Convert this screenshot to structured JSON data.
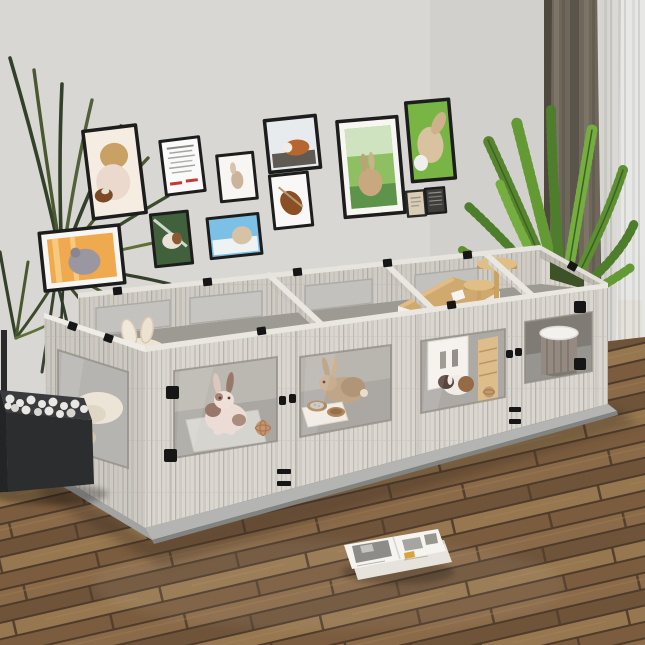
{
  "meta": {
    "description": "Room photo: whitewashed wooden small-animal playpen with clear acrylic windows holding rabbits and guinea pigs, gallery wall of pet portraits, houseplants, curtains and wood floor"
  },
  "colors": {
    "wall": "#d8d7d3",
    "wall_shade": "#c9c8c4",
    "floor_base": "#7c5e40",
    "plank_a": "#8a6a49",
    "plank_b": "#6f543a",
    "plank_c": "#96774f",
    "plank_d": "#7b5c3e",
    "plank_gap": "#4e3b2a",
    "baseboard": "#d3d2cf",
    "pen_wood": "#dad6d0",
    "pen_edge": "#eae7e1",
    "acrylic": "#c3c2be",
    "interior_floor": "#9d9a94",
    "latch_black": "#161616",
    "base_plate": "#b4b5b3",
    "leaf_dark": "#33402a",
    "leaf_mid": "#49582f",
    "palm_green": "#56842f",
    "palm_light": "#76ad41",
    "curtain": "#6e675a",
    "curtain_fold": "#5a544a",
    "sheer": "#ecebe8",
    "frame_black": "#1d1d1d",
    "mat_white": "#f7f6f3",
    "bed_cream": "#ece3d2",
    "wood_accent": "#d3af78",
    "house_roof": "#cfa96e",
    "house_white": "#f2f0ec",
    "basket_gray": "#8b8178",
    "page_white": "#f6f4f0",
    "photo_gray": "#8e8c88",
    "accent_yellow": "#d9a33c",
    "pebble_white": "#e9e7e3",
    "planter_black": "#2c2d2f"
  },
  "scene": {
    "gallery_wall": {
      "frame_count": 12,
      "frames": [
        {
          "id": "f1",
          "subject": "child-holding-guinea-pig"
        },
        {
          "id": "f2",
          "subject": "certificate-document"
        },
        {
          "id": "f3",
          "subject": "small-rabbit-print"
        },
        {
          "id": "f4",
          "subject": "guinea-pig-by-window"
        },
        {
          "id": "f5",
          "subject": "brown-guinea-pig"
        },
        {
          "id": "f6",
          "subject": "chinchilla-on-orange"
        },
        {
          "id": "f7",
          "subject": "guinea-pig-on-green"
        },
        {
          "id": "f8",
          "subject": "chinchilla-on-blue"
        },
        {
          "id": "f9",
          "subject": "rabbit-on-grass"
        },
        {
          "id": "f10",
          "subject": "rabbit-closeup"
        },
        {
          "id": "f11",
          "subject": "small-beige-print"
        },
        {
          "id": "f12",
          "subject": "small-dark-print"
        }
      ]
    },
    "playpen": {
      "material": "whitewashed-wood-with-acrylic-windows",
      "compartments": 4,
      "hardware": "black-latches-hinges-clips",
      "occupants": [
        "white-brown-rabbit",
        "tan-rabbit",
        "gray-rabbit",
        "guinea-pig-tricolor",
        "guinea-pig-dark"
      ],
      "accessories": [
        "plush-bunny-ear-bed",
        "double-feeding-bowls",
        "wicker-ball",
        "wooden-house",
        "climbing-tree-platforms",
        "wicker-basket-bed",
        "clear-floor-mat",
        "wooden-ladder"
      ]
    },
    "plants": [
      {
        "position": "left",
        "type": "dark-dracaena-palm"
      },
      {
        "position": "right",
        "type": "areca-palm-in-dark-pot"
      }
    ],
    "window_treatment": [
      "dark-olive-curtain",
      "white-sheer-curtain"
    ],
    "floor_items": [
      {
        "id": "pebble-planter",
        "desc": "black-tray-with-white-pebbles"
      },
      {
        "id": "magazine",
        "desc": "open-magazine-on-floor"
      }
    ]
  }
}
